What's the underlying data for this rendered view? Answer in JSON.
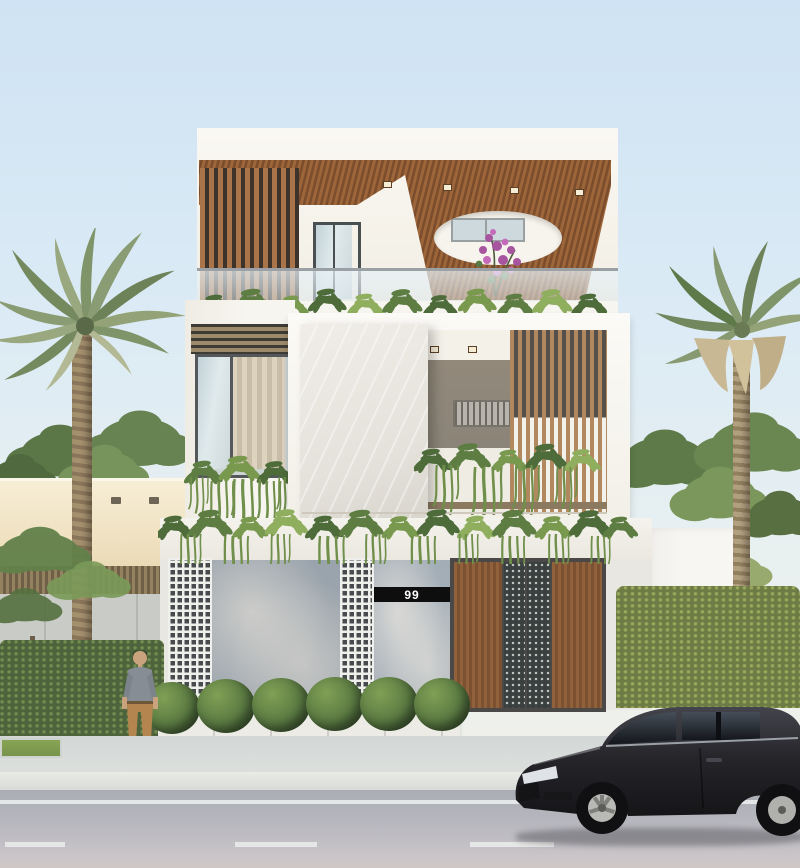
{
  "scene": {
    "description": "modern three-storey house render",
    "house_number": "99"
  },
  "palette": {
    "sky-top": "#cfe3f4",
    "house-white": "#f7f5f0",
    "cream-wall": "#f0e2c2",
    "panel-gray": "#a3aab1",
    "breeze-hole": "#474b4e",
    "gate-metal": "#3a3f3f",
    "gate-wood": "#8a5c39",
    "marble": "#e4e1da",
    "interior-gray": "#8b8478",
    "hedge": "#4c633b",
    "leaf-dark": "#3f5a33",
    "leaf-mid": "#5d7d43",
    "leaf-light": "#8fae5e",
    "palm-frond": "#7f9468",
    "palm-dried": "#c8b894",
    "trunk": "#a5906e",
    "road": "#aaadb6",
    "sidewalk": "#dcdfdc",
    "curb": "#e9ebe6",
    "line-white": "#eef0ee",
    "car-body": "#232327",
    "strip-black": "#0e0e0e",
    "strip-text": "#ffffff"
  }
}
